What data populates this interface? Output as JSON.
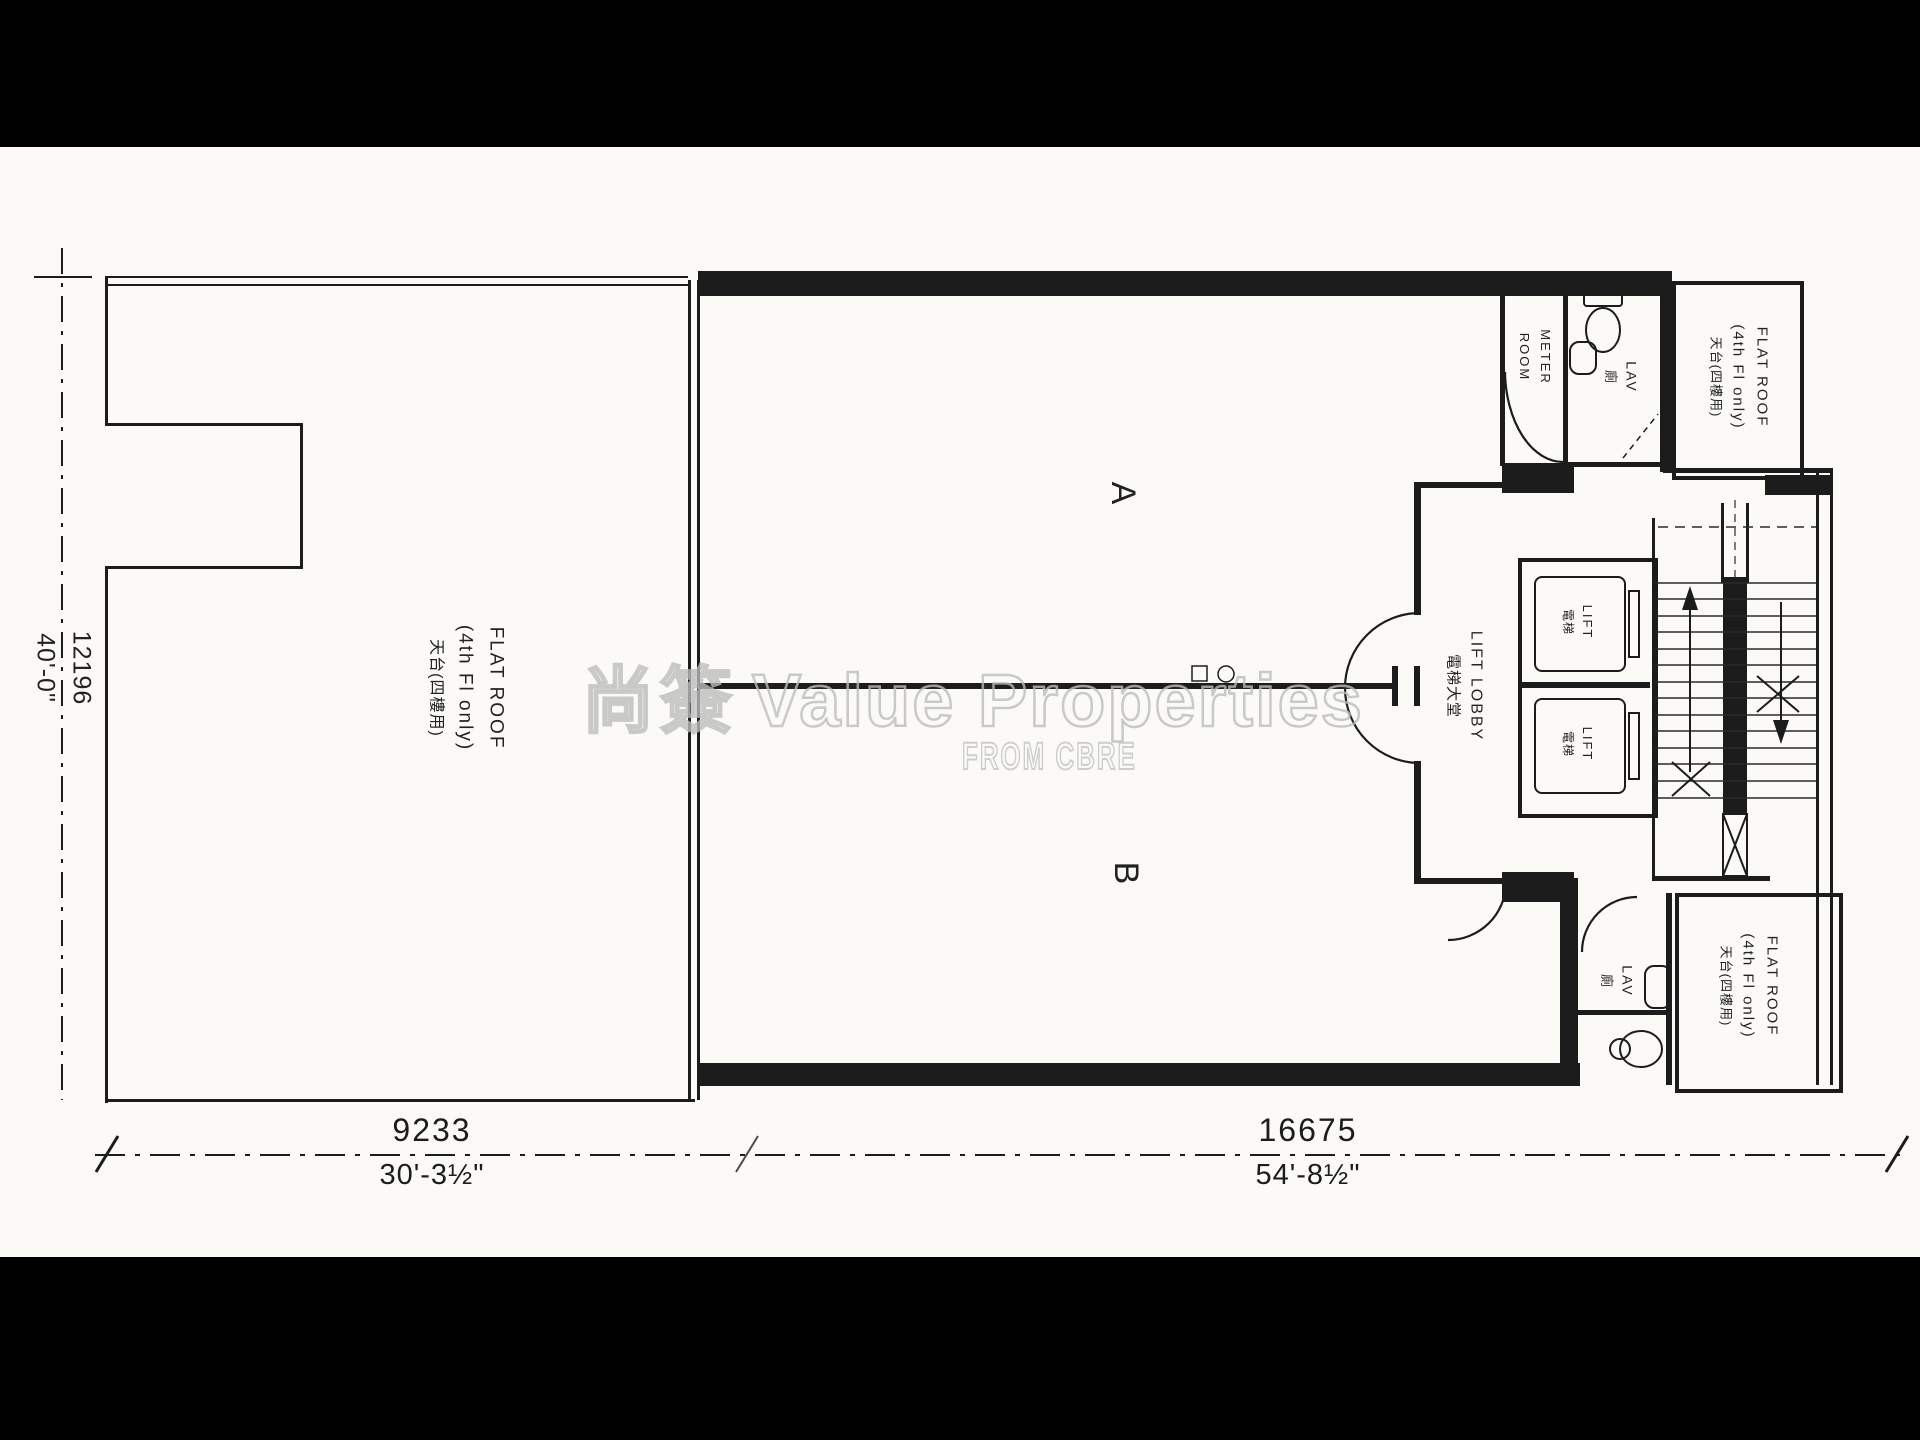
{
  "watermark": {
    "cjk": "尚簽",
    "brand": "Value Properties",
    "source": "FROM CBRE"
  },
  "labels": {
    "flat_roof_left": {
      "en": "FLAT ROOF",
      "note": "(4th Fl only)",
      "cn": "天台(四樓用)"
    },
    "flat_roof_top_right": {
      "en": "FLAT ROOF",
      "note": "(4th Fl only)",
      "cn": "天台(四樓用)"
    },
    "flat_roof_bottom_right": {
      "en": "FLAT ROOF",
      "note": "(4th Fl only)",
      "cn": "天台(四樓用)"
    },
    "unit_a": "A",
    "unit_b": "B",
    "lift_lobby": {
      "en": "LIFT LOBBY",
      "cn": "電梯大堂"
    },
    "lift_upper": {
      "en": "LIFT",
      "cn": "電梯"
    },
    "lift_lower": {
      "en": "LIFT",
      "cn": "電梯"
    },
    "meter_room": {
      "line1": "METER",
      "line2": "ROOM"
    },
    "lav_upper": {
      "en": "LAV",
      "cn": "廁"
    },
    "lav_lower": {
      "en": "LAV",
      "cn": "廁"
    }
  },
  "dimensions": {
    "left": {
      "metric": "12196",
      "imperial": "40'-0\""
    },
    "bottom_left": {
      "metric": "9233",
      "imperial": "30'-3½\""
    },
    "bottom_right": {
      "metric": "16675",
      "imperial": "54'-8½\""
    }
  },
  "colors": {
    "ink": "#1c1c1c",
    "paper": "#fbfaf7",
    "letterbox": "#000000",
    "watermark": "#bdbdbd"
  }
}
